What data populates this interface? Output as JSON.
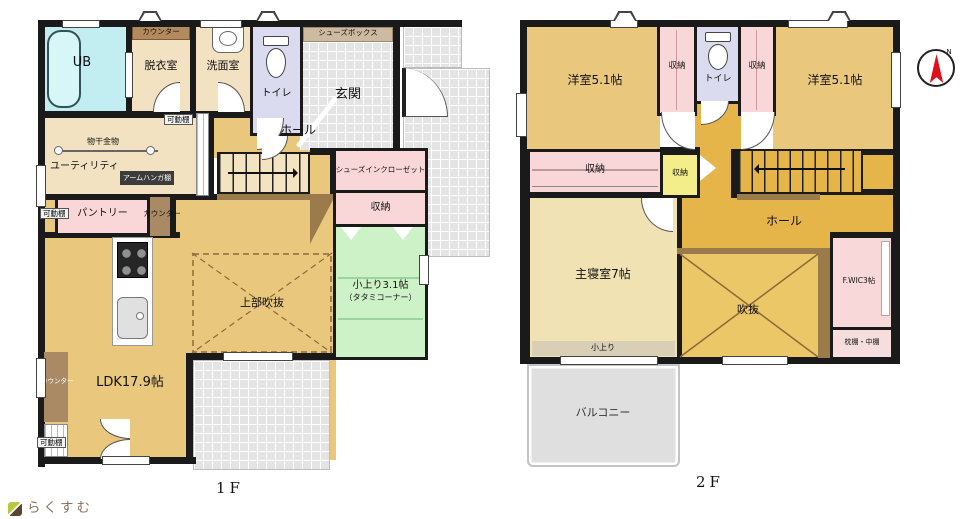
{
  "colors": {
    "wall": "#1a1a1a",
    "room_tan": "#e9c87e",
    "room_light_tan": "#f3e2c2",
    "hall_gold": "#e5b54a",
    "void_gold": "#ecc768",
    "closet_pink": "#f9d6d8",
    "tatami_green": "#cdf2c7",
    "bath_cyan": "#c2eef2",
    "toilet_lavender": "#dbdbf0",
    "tile_gray": "#e4e4e4",
    "balcony_gray": "#dfdfdf",
    "beam_brown": "#9b7b4b",
    "counter_brown": "#a98a64",
    "shoebox_tan": "#cdbaa1",
    "closet_yellow": "#f4ee8a",
    "compass_red": "#e0101a",
    "brand_brown": "#8a7460"
  },
  "floor1": {
    "title": "1F",
    "labels": {
      "ub": "UB",
      "counter": "カウンター",
      "kado": "可動棚",
      "datsui": "脱衣室",
      "senmen": "洗面室",
      "toilet": "トイレ",
      "genkan": "玄関",
      "shoes_box": "シューズボックス",
      "hall": "ホール",
      "shoes_closet": "シューズインクローゼット",
      "shuno": "収納",
      "tatami_size": "小上り3.1帖",
      "tatami_note": "（タタミコーナー）",
      "monohoshi": "物干金物",
      "utility": "ユーティリティ",
      "arm_hanger": "アームハンガ棚",
      "pantry": "パントリー",
      "ldk": "LDK17.9帖",
      "upper_void": "上部吹抜"
    }
  },
  "floor2": {
    "title": "2F",
    "labels": {
      "yoshitsu": "洋室5.1帖",
      "shuno": "収納",
      "toilet": "トイレ",
      "hall": "ホール",
      "master": "主寝室7帖",
      "void": "吹抜",
      "fwic": "F.WIC3帖",
      "makura": "枕棚・中棚",
      "koagari": "小上り",
      "balcony": "バルコニー"
    }
  },
  "compass": {
    "n": "N"
  },
  "footer": {
    "brand": "らくすむ"
  }
}
